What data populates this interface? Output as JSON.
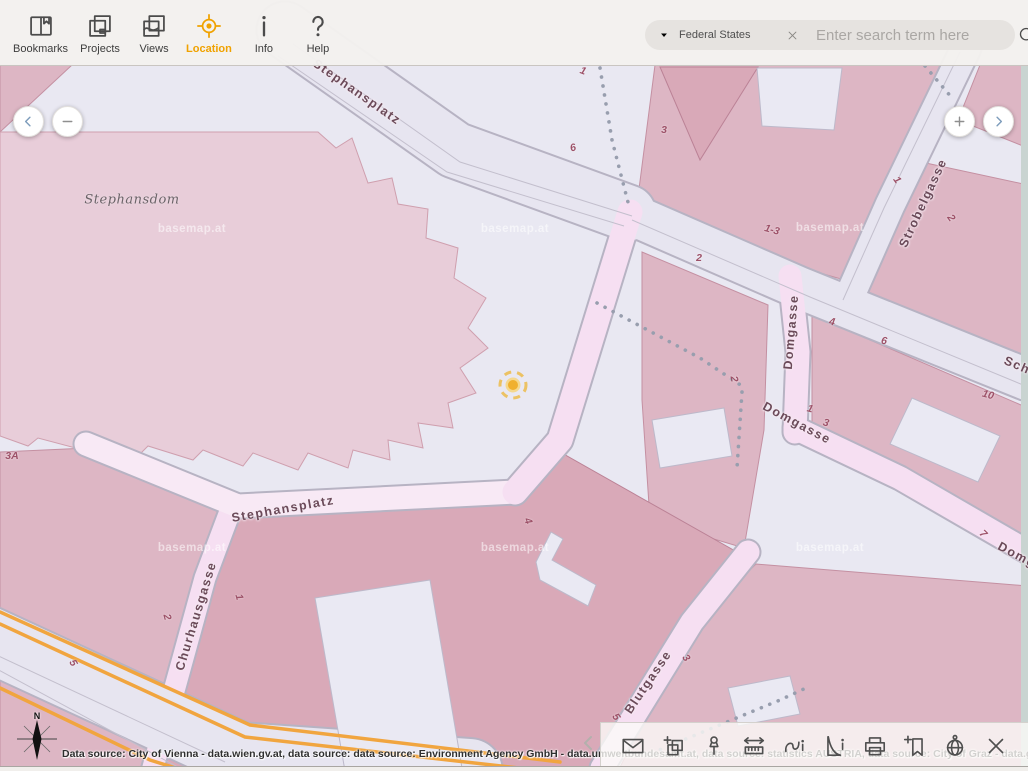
{
  "attribution": {
    "text": "Data source: City of Vienna - data.wien.gv.at, data source: data source: Environment Agency GmbH - data.umweltbundesamt.at, data source: statistics AUSTRIA, data source: City of Graz - data.graz.gv.at"
  },
  "toolbar": {
    "items": [
      {
        "id": "toolbar-item-bookmarks",
        "label": "Bookmarks",
        "icon": "bookmarks"
      },
      {
        "id": "toolbar-item-projects",
        "label": "Projects",
        "icon": "projects"
      },
      {
        "id": "toolbar-item-views",
        "label": "Views",
        "icon": "views"
      },
      {
        "id": "toolbar-item-location",
        "label": "Location",
        "icon": "location",
        "cls": "active"
      },
      {
        "id": "toolbar-item-info",
        "label": "Info",
        "icon": "info"
      },
      {
        "id": "toolbar-item-help",
        "label": "Help",
        "icon": "help"
      }
    ]
  },
  "search": {
    "category": "Federal States",
    "placeholder": "Enter search term here",
    "icons": [
      "caret-down",
      "clear",
      "search"
    ]
  },
  "map_nav": {
    "buttons": [
      {
        "id": "history-back-button",
        "icon": "chevron-left",
        "x": 13,
        "y": 106,
        "cls": "blue"
      },
      {
        "id": "zoom-out-button",
        "icon": "minus",
        "x": 52,
        "y": 106,
        "cls": "gray"
      },
      {
        "id": "zoom-in-button",
        "icon": "plus",
        "x": 944,
        "y": 106,
        "cls": "gray"
      },
      {
        "id": "history-forward-button",
        "icon": "chevron-right",
        "x": 983,
        "y": 106,
        "cls": "blue"
      }
    ]
  },
  "bottom_toolbar": {
    "collapse_icon": "chevron-left",
    "items": [
      {
        "id": "send-email-button",
        "icon": "envelope"
      },
      {
        "id": "add-layers-button",
        "icon": "layers-plus"
      },
      {
        "id": "set-pin-button",
        "icon": "pin"
      },
      {
        "id": "measure-button",
        "icon": "measure"
      },
      {
        "id": "line-info-button",
        "icon": "polyline-info"
      },
      {
        "id": "page-info-button",
        "icon": "page-info"
      },
      {
        "id": "print-button",
        "icon": "printer"
      },
      {
        "id": "add-bookmark-button",
        "icon": "bookmark-plus"
      },
      {
        "id": "locate-button",
        "icon": "globe"
      },
      {
        "id": "close-button",
        "icon": "close"
      }
    ]
  },
  "map": {
    "compass": {
      "label": "N"
    },
    "poi_labels": [
      {
        "text": "Stephansdom",
        "x": 132,
        "y": 200
      }
    ],
    "street_labels": [
      {
        "text": "Stephansplatz",
        "x": 357,
        "y": 92,
        "rot": 35
      },
      {
        "text": "Stephansplatz",
        "x": 283,
        "y": 509,
        "rot": -10
      },
      {
        "text": "Churhausgasse",
        "x": 196,
        "y": 616,
        "rot": -73
      },
      {
        "text": "Domgasse",
        "x": 791,
        "y": 332,
        "rot": -85
      },
      {
        "text": "Domgasse",
        "x": 797,
        "y": 423,
        "rot": 28
      },
      {
        "text": "Domgasse",
        "x": 1032,
        "y": 563,
        "rot": 28
      },
      {
        "text": "Strobelgasse",
        "x": 923,
        "y": 203,
        "rot": -65
      },
      {
        "text": "Blutgasse",
        "x": 648,
        "y": 682,
        "rot": -56
      },
      {
        "text": "Schulerstraße",
        "x": 1052,
        "y": 380,
        "rot": 23
      }
    ],
    "building_numbers": [
      {
        "text": "1",
        "x": 583,
        "y": 71,
        "rot": 20
      },
      {
        "text": "3",
        "x": 664,
        "y": 130,
        "rot": 0
      },
      {
        "text": "6",
        "x": 573,
        "y": 148,
        "rot": -15
      },
      {
        "text": "1-3",
        "x": 772,
        "y": 230,
        "rot": 15
      },
      {
        "text": "2",
        "x": 699,
        "y": 258,
        "rot": 0
      },
      {
        "text": "1",
        "x": 897,
        "y": 180,
        "rot": 55
      },
      {
        "text": "2",
        "x": 951,
        "y": 218,
        "rot": 55
      },
      {
        "text": "4",
        "x": 832,
        "y": 322,
        "rot": 10
      },
      {
        "text": "6",
        "x": 884,
        "y": 341,
        "rot": 10
      },
      {
        "text": "2",
        "x": 734,
        "y": 379,
        "rot": 80
      },
      {
        "text": "1",
        "x": 810,
        "y": 409,
        "rot": 15
      },
      {
        "text": "3",
        "x": 826,
        "y": 423,
        "rot": 15
      },
      {
        "text": "10",
        "x": 988,
        "y": 395,
        "rot": 15
      },
      {
        "text": "7",
        "x": 983,
        "y": 534,
        "rot": 45
      },
      {
        "text": "4",
        "x": 528,
        "y": 521,
        "rot": 70
      },
      {
        "text": "3A",
        "x": 12,
        "y": 456,
        "rot": 0
      },
      {
        "text": "2",
        "x": 167,
        "y": 617,
        "rot": 75
      },
      {
        "text": "1",
        "x": 239,
        "y": 597,
        "rot": 75
      },
      {
        "text": "5",
        "x": 73,
        "y": 663,
        "rot": 60
      },
      {
        "text": "3",
        "x": 686,
        "y": 658,
        "rot": 55
      },
      {
        "text": "5",
        "x": 616,
        "y": 717,
        "rot": 55
      }
    ],
    "watermarks": [
      {
        "text": "basemap.at",
        "x": 192,
        "y": 229
      },
      {
        "text": "basemap.at",
        "x": 515,
        "y": 229
      },
      {
        "text": "basemap.at",
        "x": 830,
        "y": 228
      },
      {
        "text": "basemap.at",
        "x": 192,
        "y": 548
      },
      {
        "text": "basemap.at",
        "x": 515,
        "y": 548
      },
      {
        "text": "basemap.at",
        "x": 830,
        "y": 548
      }
    ]
  },
  "colors": {
    "accent_orange": "#f0a200",
    "plaza": "#e9e8f2",
    "building_light": "#e8cdd9",
    "building_mid": "#ddb6c4",
    "building_dark": "#d9a9b8",
    "street_pink": "#f6dff2",
    "tram_orange": "#f1a53f",
    "street_label": "#6b4a59",
    "number_label": "#9d5168"
  }
}
